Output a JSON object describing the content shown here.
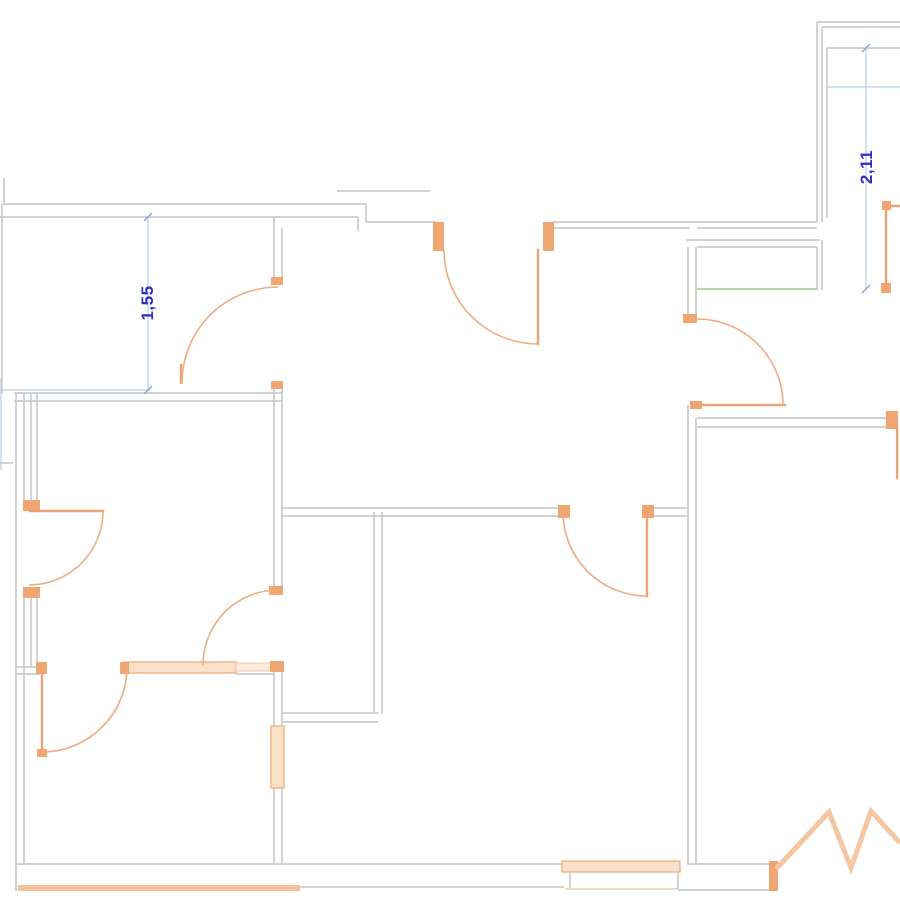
{
  "canvas": {
    "width": 900,
    "height": 900,
    "background": "#ffffff"
  },
  "colors": {
    "wall_gray": "#cbcbcb",
    "door_orange": "#eda275",
    "arc_orange": "#f0ab80",
    "jamb_orange": "#efa16c",
    "window_fill": "#fadfc9",
    "green_threshold": "#b5d6ab",
    "dimension_line_blue": "#b8cde8",
    "dimension_text_blue": "#2d2dc5"
  },
  "dimensions": [
    {
      "label": "1,55",
      "x": 148,
      "y": 303,
      "rotation": -90
    },
    {
      "label": "2,11",
      "x": 867,
      "y": 167,
      "rotation": -90
    }
  ],
  "plan": {
    "wall_lines": [
      [
        4,
        178,
        4,
        205
      ],
      [
        4,
        204,
        366,
        204
      ],
      [
        0,
        217,
        358,
        217
      ],
      [
        366,
        204,
        366,
        222
      ],
      [
        366,
        222,
        436,
        222
      ],
      [
        358,
        217,
        358,
        231
      ],
      [
        337,
        191,
        430,
        191
      ],
      [
        553,
        222,
        817,
        222
      ],
      [
        553,
        228,
        690,
        228
      ],
      [
        697,
        228,
        817,
        228
      ],
      [
        817,
        22,
        900,
        22
      ],
      [
        822,
        27,
        900,
        27
      ],
      [
        817,
        22,
        817,
        222
      ],
      [
        822,
        27,
        822,
        222
      ],
      [
        827,
        48,
        900,
        48
      ],
      [
        827,
        48,
        827,
        218
      ],
      [
        686,
        240,
        820,
        240
      ],
      [
        697,
        247,
        817,
        247
      ],
      [
        817,
        247,
        817,
        289
      ],
      [
        822,
        240,
        822,
        290
      ],
      [
        688,
        247,
        688,
        322
      ],
      [
        696,
        247,
        696,
        317
      ],
      [
        688,
        405,
        688,
        864
      ],
      [
        696,
        418,
        696,
        864
      ],
      [
        697,
        418,
        888,
        418
      ],
      [
        697,
        427,
        888,
        427
      ],
      [
        283,
        508,
        562,
        508
      ],
      [
        283,
        516,
        562,
        516
      ],
      [
        645,
        508,
        688,
        508
      ],
      [
        645,
        516,
        688,
        516
      ],
      [
        14,
        393,
        283,
        393
      ],
      [
        14,
        401,
        283,
        401
      ],
      [
        2,
        204,
        2,
        393
      ],
      [
        16,
        394,
        16,
        891
      ],
      [
        24,
        394,
        24,
        505
      ],
      [
        24,
        594,
        24,
        864
      ],
      [
        31,
        394,
        31,
        505
      ],
      [
        37,
        394,
        37,
        505
      ],
      [
        31,
        594,
        31,
        667
      ],
      [
        37,
        594,
        37,
        667
      ],
      [
        16,
        667,
        40,
        667
      ],
      [
        16,
        674,
        40,
        674
      ],
      [
        236,
        674,
        274,
        674
      ],
      [
        274,
        217,
        274,
        280
      ],
      [
        282,
        228,
        282,
        280
      ],
      [
        274,
        386,
        274,
        592
      ],
      [
        282,
        386,
        282,
        592
      ],
      [
        274,
        662,
        274,
        727
      ],
      [
        282,
        662,
        282,
        727
      ],
      [
        274,
        787,
        274,
        864
      ],
      [
        282,
        787,
        282,
        864
      ],
      [
        374,
        512,
        374,
        714
      ],
      [
        382,
        512,
        382,
        714
      ],
      [
        283,
        713,
        378,
        713
      ],
      [
        283,
        722,
        378,
        722
      ],
      [
        16,
        864,
        564,
        864
      ],
      [
        283,
        887,
        564,
        887
      ],
      [
        570,
        864,
        570,
        888
      ],
      [
        687,
        864,
        776,
        864
      ],
      [
        678,
        890,
        776,
        890
      ],
      [
        678,
        864,
        678,
        890
      ],
      [
        0,
        463,
        13,
        463
      ]
    ],
    "door_leaves": [
      [
        538,
        250,
        538,
        344
      ],
      [
        697,
        405,
        785,
        405
      ],
      [
        30,
        511,
        103,
        511
      ],
      [
        647,
        512,
        647,
        596
      ],
      [
        42,
        667,
        42,
        752
      ],
      [
        886,
        205,
        886,
        290
      ],
      [
        886,
        206,
        900,
        206
      ],
      [
        897,
        428,
        897,
        478
      ],
      [
        181,
        365,
        181,
        383
      ]
    ],
    "door_arcs": [
      [
        444,
        250,
        94,
        538,
        344,
        0
      ],
      [
        697,
        319,
        86,
        783,
        405,
        1
      ],
      [
        103,
        511,
        74,
        29,
        585,
        1
      ],
      [
        647,
        596,
        84,
        563,
        512,
        1
      ],
      [
        42,
        752,
        85,
        127,
        667,
        0
      ],
      [
        278,
        590,
        75,
        203,
        665,
        0
      ],
      [
        278,
        287,
        96,
        182,
        383,
        0
      ]
    ],
    "jamb_markers": [
      [
        433,
        222,
        11,
        29
      ],
      [
        543,
        222,
        11,
        29
      ],
      [
        683,
        314,
        14,
        9
      ],
      [
        690,
        401,
        12,
        8
      ],
      [
        886,
        411,
        12,
        18
      ],
      [
        271,
        277,
        12,
        8
      ],
      [
        271,
        381,
        12,
        8
      ],
      [
        23,
        500,
        17,
        11
      ],
      [
        23,
        587,
        17,
        11
      ],
      [
        558,
        505,
        12,
        13
      ],
      [
        642,
        505,
        12,
        13
      ],
      [
        36,
        662,
        11,
        12
      ],
      [
        120,
        662,
        9,
        12
      ],
      [
        269,
        586,
        14,
        9
      ],
      [
        270,
        661,
        14,
        11
      ],
      [
        882,
        201,
        9,
        9
      ],
      [
        881,
        283,
        10,
        10
      ],
      [
        769,
        861,
        9,
        30
      ],
      [
        37,
        749,
        10,
        8
      ]
    ],
    "windows": [
      [
        124,
        662,
        112,
        11
      ],
      [
        562,
        861,
        118,
        11
      ],
      [
        271,
        726,
        13,
        62
      ]
    ],
    "windows_light": [
      [
        236,
        663,
        40,
        8
      ]
    ],
    "window_lines": [
      [
        565,
        889,
        678,
        889
      ]
    ],
    "green_lines": [
      [
        697,
        289,
        818,
        289
      ]
    ],
    "dim_lines": [
      [
        148,
        216,
        148,
        390
      ],
      [
        0,
        390,
        150,
        390
      ],
      [
        866,
        48,
        866,
        289
      ],
      [
        827,
        87,
        900,
        87
      ],
      [
        1,
        378,
        1,
        470
      ]
    ],
    "dim_ticks": [
      [
        144,
        221,
        152,
        213
      ],
      [
        144,
        394,
        152,
        386
      ],
      [
        862,
        52,
        870,
        44
      ],
      [
        862,
        293,
        870,
        285
      ]
    ],
    "thick_lines": [
      [
        18,
        888,
        300,
        888
      ]
    ],
    "break_zigzag": "776,869 829,812 851,868 871,811 900,843"
  }
}
